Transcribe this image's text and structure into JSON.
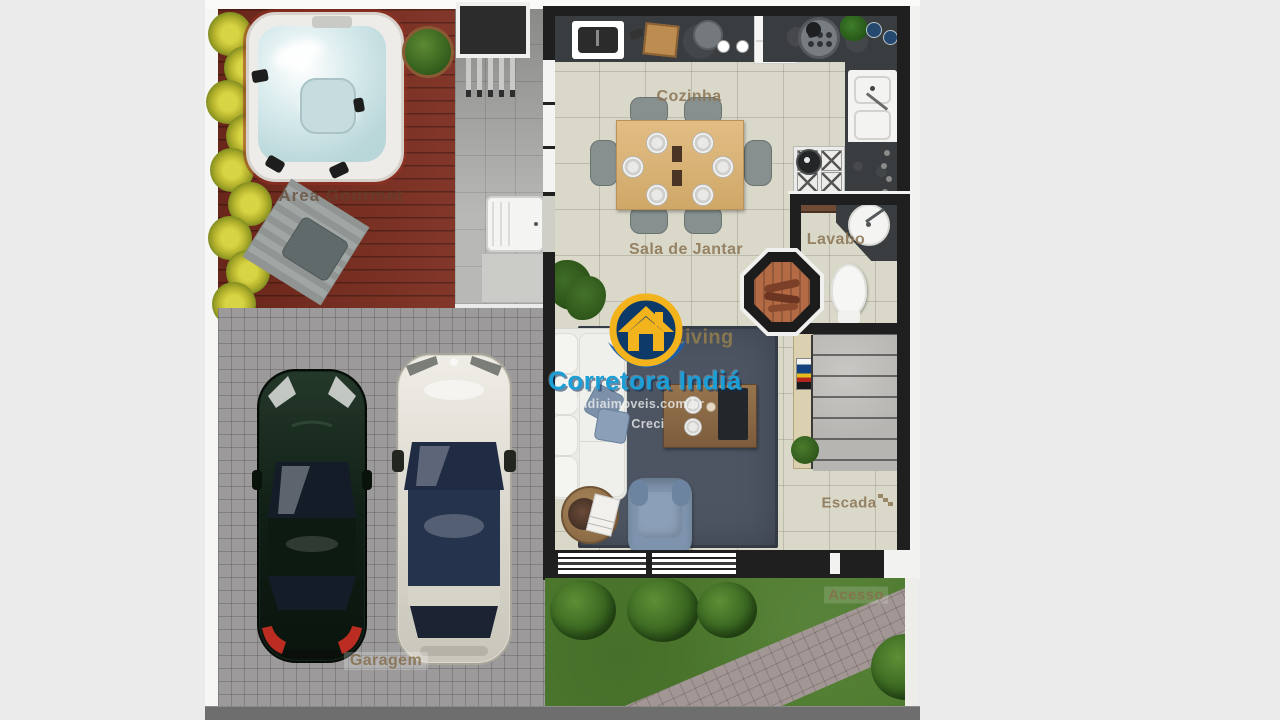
{
  "plan": {
    "labels": {
      "area_gourmet": "Área Gourmet",
      "cozinha": "Cozinha",
      "sala_de_jantar": "Sala de Jantar",
      "lavabo": "Lavabo",
      "living": "Living",
      "escada": "Escada",
      "acesso": "Acesso",
      "garagem": "Garagem"
    },
    "watermark": {
      "brand": "Corretora Indiá",
      "website": "indiaimoveis.com.br",
      "license": "Creci"
    },
    "colors": {
      "bg": "#ebebeb",
      "fence": "#f6f6f4",
      "wall": "#1f1f1f",
      "floor": "#d9d8c9",
      "deck": "#7b2c1e",
      "counter": "#3a3d40",
      "pavers": "#9c9a9b",
      "walkway": "#a39795",
      "grass": "#4e7b2e",
      "rug": "#4d5563",
      "stairs": "#b7b5b1",
      "street": "#6e6e6e",
      "label": "#8a7352",
      "brand_blue": "#1b9fd6",
      "logo_navy": "#0e3a6a",
      "logo_gold": "#f2b31c",
      "car_dark": "#16251b",
      "car_light": "#ddd9cf"
    }
  }
}
